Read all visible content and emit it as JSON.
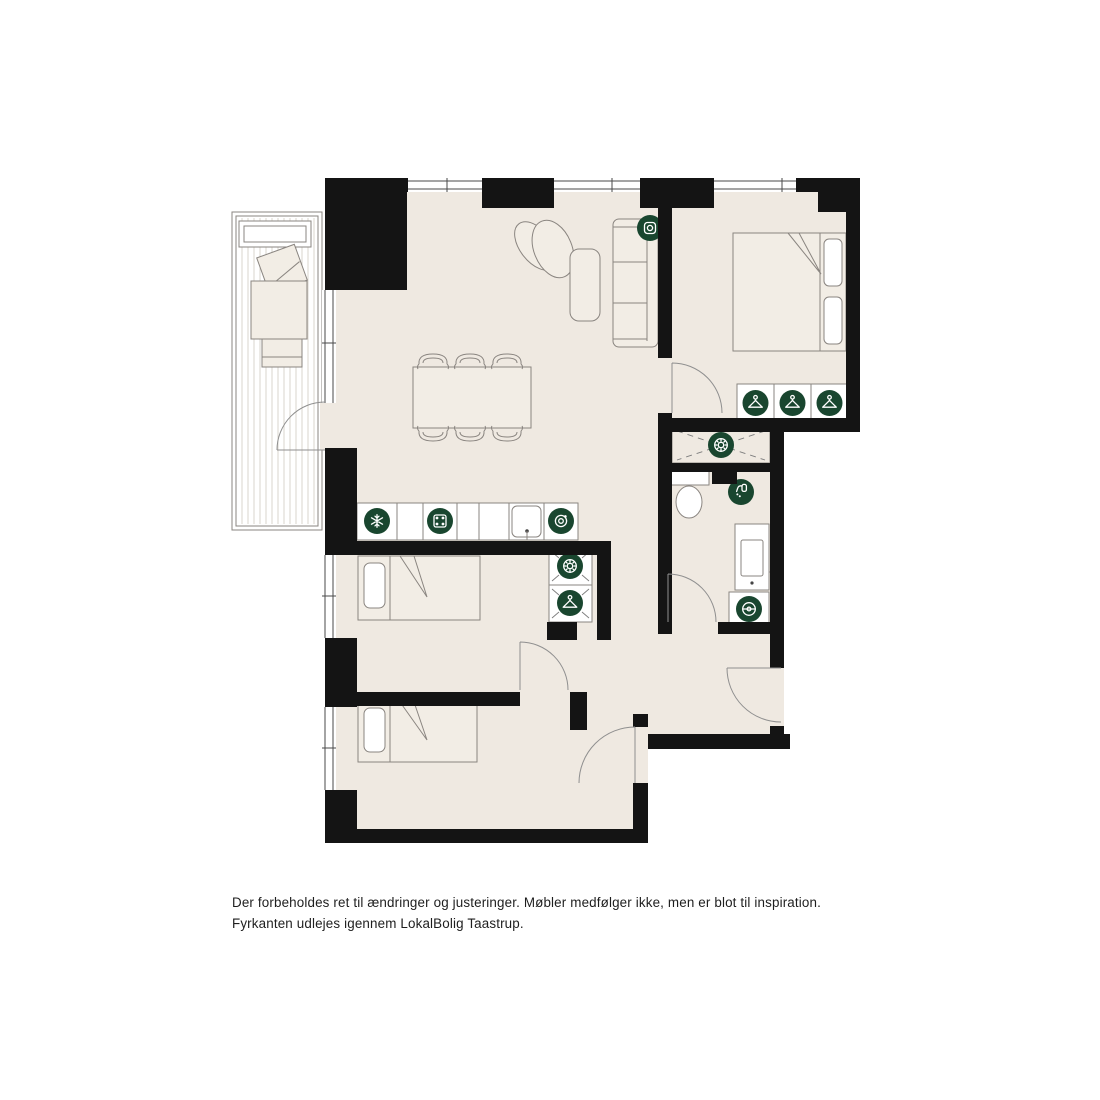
{
  "disclaimer": {
    "line1": "Der forbeholdes ret til ændringer og justeringer. Møbler medfølger ikke, men er blot til inspiration.",
    "line2": "Fyrkanten udlejes igennem LokalBolig Taastrup."
  },
  "plan": {
    "colors": {
      "wall": "#141414",
      "floor": "#EFE9E1",
      "icon_background": "#19462F",
      "icon_foreground": "#FFFFFF",
      "furniture_outline": "#8A8580",
      "background": "#FFFFFF",
      "text": "#1E1E1E"
    },
    "rooms": [
      "balcony",
      "living-dining-room",
      "kitchen",
      "bedroom-1",
      "bedroom-2",
      "bedroom-3",
      "bathroom",
      "hallway",
      "entry"
    ],
    "icons": [
      {
        "name": "appliance-square-icon",
        "room": "living-dining-room",
        "count": 2
      },
      {
        "name": "fridge-snowflake-icon",
        "room": "kitchen",
        "count": 1
      },
      {
        "name": "stove-icon",
        "room": "kitchen",
        "count": 1
      },
      {
        "name": "dishwasher-icon",
        "room": "kitchen",
        "count": 1
      },
      {
        "name": "laundry-drum-icon",
        "room": "hall-closet",
        "count": 1
      },
      {
        "name": "laundry-drum-icon",
        "room": "bedroom-2-closet",
        "count": 1
      },
      {
        "name": "hanger-icon",
        "room": "bedroom-2-closet",
        "count": 1
      },
      {
        "name": "hanger-icon",
        "room": "bedroom-1-wardrobe",
        "count": 3
      },
      {
        "name": "shower-icon",
        "room": "bathroom",
        "count": 1
      },
      {
        "name": "washing-machine-icon",
        "room": "bathroom",
        "count": 1
      }
    ]
  }
}
